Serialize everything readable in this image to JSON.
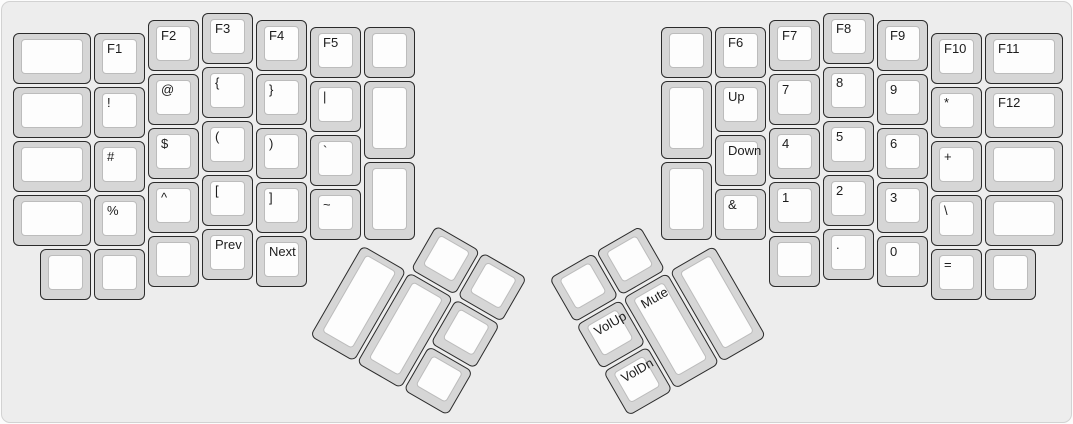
{
  "colors": {
    "board_background": "#ededed",
    "board_border": "#d2d2d2",
    "key_bezel": "#d6d6d6",
    "key_border": "#2b2b2b",
    "keytop": "#fdfdfd",
    "label_color": "#1c1c1c"
  },
  "keyboard": {
    "left_main": {
      "keys": [
        {
          "label": "",
          "name": "key-blank",
          "x": 0,
          "y": 0.375,
          "w": 1.5,
          "h": 1
        },
        {
          "label": "F1",
          "name": "key-f1",
          "x": 1.5,
          "y": 0.375,
          "w": 1,
          "h": 1
        },
        {
          "label": "F2",
          "name": "key-f2",
          "x": 2.5,
          "y": 0.125,
          "w": 1,
          "h": 1
        },
        {
          "label": "F3",
          "name": "key-f3",
          "x": 3.5,
          "y": 0,
          "w": 1,
          "h": 1
        },
        {
          "label": "F4",
          "name": "key-f4",
          "x": 4.5,
          "y": 0.125,
          "w": 1,
          "h": 1
        },
        {
          "label": "F5",
          "name": "key-f5",
          "x": 5.5,
          "y": 0.25,
          "w": 1,
          "h": 1
        },
        {
          "label": "",
          "name": "key-blank",
          "x": 6.5,
          "y": 0.25,
          "w": 1,
          "h": 1
        },
        {
          "label": "",
          "name": "key-blank",
          "x": 0,
          "y": 1.375,
          "w": 1.5,
          "h": 1
        },
        {
          "label": "!",
          "name": "key-exclamation",
          "x": 1.5,
          "y": 1.375,
          "w": 1,
          "h": 1
        },
        {
          "label": "@",
          "name": "key-at",
          "x": 2.5,
          "y": 1.125,
          "w": 1,
          "h": 1
        },
        {
          "label": "{",
          "name": "key-left-brace",
          "x": 3.5,
          "y": 1,
          "w": 1,
          "h": 1
        },
        {
          "label": "}",
          "name": "key-right-brace",
          "x": 4.5,
          "y": 1.125,
          "w": 1,
          "h": 1
        },
        {
          "label": "|",
          "name": "key-pipe",
          "x": 5.5,
          "y": 1.25,
          "w": 1,
          "h": 1
        },
        {
          "label": "",
          "name": "key-blank",
          "x": 6.5,
          "y": 1.25,
          "w": 1,
          "h": 1.5
        },
        {
          "label": "",
          "name": "key-blank",
          "x": 0,
          "y": 2.375,
          "w": 1.5,
          "h": 1
        },
        {
          "label": "#",
          "name": "key-hash",
          "x": 1.5,
          "y": 2.375,
          "w": 1,
          "h": 1
        },
        {
          "label": "$",
          "name": "key-dollar",
          "x": 2.5,
          "y": 2.125,
          "w": 1,
          "h": 1
        },
        {
          "label": "(",
          "name": "key-left-paren",
          "x": 3.5,
          "y": 2,
          "w": 1,
          "h": 1
        },
        {
          "label": ")",
          "name": "key-right-paren",
          "x": 4.5,
          "y": 2.125,
          "w": 1,
          "h": 1
        },
        {
          "label": "`",
          "name": "key-backtick",
          "x": 5.5,
          "y": 2.25,
          "w": 1,
          "h": 1
        },
        {
          "label": "",
          "name": "key-blank",
          "x": 0,
          "y": 3.375,
          "w": 1.5,
          "h": 1
        },
        {
          "label": "%",
          "name": "key-percent",
          "x": 1.5,
          "y": 3.375,
          "w": 1,
          "h": 1
        },
        {
          "label": "^",
          "name": "key-caret",
          "x": 2.5,
          "y": 3.125,
          "w": 1,
          "h": 1
        },
        {
          "label": "[",
          "name": "key-left-bracket",
          "x": 3.5,
          "y": 3,
          "w": 1,
          "h": 1
        },
        {
          "label": "]",
          "name": "key-right-bracket",
          "x": 4.5,
          "y": 3.125,
          "w": 1,
          "h": 1
        },
        {
          "label": "~",
          "name": "key-tilde",
          "x": 5.5,
          "y": 3.25,
          "w": 1,
          "h": 1
        },
        {
          "label": "",
          "name": "key-blank",
          "x": 6.5,
          "y": 2.75,
          "w": 1,
          "h": 1.5
        },
        {
          "label": "",
          "name": "key-blank",
          "x": 0.5,
          "y": 4.375,
          "w": 1,
          "h": 1
        },
        {
          "label": "",
          "name": "key-blank",
          "x": 1.5,
          "y": 4.375,
          "w": 1,
          "h": 1
        },
        {
          "label": "",
          "name": "key-blank",
          "x": 2.5,
          "y": 4.125,
          "w": 1,
          "h": 1
        },
        {
          "label": "Prev",
          "name": "key-prev-track",
          "x": 3.5,
          "y": 4,
          "w": 1,
          "h": 1
        },
        {
          "label": "Next",
          "name": "key-next-track",
          "x": 4.5,
          "y": 4.125,
          "w": 1,
          "h": 1
        }
      ]
    },
    "right_main": {
      "keys": [
        {
          "label": "",
          "name": "key-blank",
          "x": 0,
          "y": 0.25,
          "w": 1,
          "h": 1
        },
        {
          "label": "F6",
          "name": "key-f6",
          "x": 1,
          "y": 0.25,
          "w": 1,
          "h": 1
        },
        {
          "label": "F7",
          "name": "key-f7",
          "x": 2,
          "y": 0.125,
          "w": 1,
          "h": 1
        },
        {
          "label": "F8",
          "name": "key-f8",
          "x": 3,
          "y": 0,
          "w": 1,
          "h": 1
        },
        {
          "label": "F9",
          "name": "key-f9",
          "x": 4,
          "y": 0.125,
          "w": 1,
          "h": 1
        },
        {
          "label": "F10",
          "name": "key-f10",
          "x": 5,
          "y": 0.375,
          "w": 1,
          "h": 1
        },
        {
          "label": "F11",
          "name": "key-f11",
          "x": 6,
          "y": 0.375,
          "w": 1.5,
          "h": 1
        },
        {
          "label": "",
          "name": "key-blank",
          "x": 0,
          "y": 1.25,
          "w": 1,
          "h": 1.5
        },
        {
          "label": "Up",
          "name": "key-up",
          "x": 1,
          "y": 1.25,
          "w": 1,
          "h": 1
        },
        {
          "label": "7",
          "name": "key-7",
          "x": 2,
          "y": 1.125,
          "w": 1,
          "h": 1
        },
        {
          "label": "8",
          "name": "key-8",
          "x": 3,
          "y": 1,
          "w": 1,
          "h": 1
        },
        {
          "label": "9",
          "name": "key-9",
          "x": 4,
          "y": 1.125,
          "w": 1,
          "h": 1
        },
        {
          "label": "*",
          "name": "key-asterisk",
          "x": 5,
          "y": 1.375,
          "w": 1,
          "h": 1
        },
        {
          "label": "F12",
          "name": "key-f12",
          "x": 6,
          "y": 1.375,
          "w": 1.5,
          "h": 1
        },
        {
          "label": "Down",
          "name": "key-down",
          "x": 1,
          "y": 2.25,
          "w": 1,
          "h": 1
        },
        {
          "label": "4",
          "name": "key-4",
          "x": 2,
          "y": 2.125,
          "w": 1,
          "h": 1
        },
        {
          "label": "5",
          "name": "key-5",
          "x": 3,
          "y": 2,
          "w": 1,
          "h": 1
        },
        {
          "label": "6",
          "name": "key-6",
          "x": 4,
          "y": 2.125,
          "w": 1,
          "h": 1
        },
        {
          "label": "+",
          "name": "key-plus",
          "x": 5,
          "y": 2.375,
          "w": 1,
          "h": 1
        },
        {
          "label": "",
          "name": "key-blank",
          "x": 6,
          "y": 2.375,
          "w": 1.5,
          "h": 1
        },
        {
          "label": "",
          "name": "key-blank",
          "x": 0,
          "y": 2.75,
          "w": 1,
          "h": 1.5
        },
        {
          "label": "&",
          "name": "key-ampersand",
          "x": 1,
          "y": 3.25,
          "w": 1,
          "h": 1
        },
        {
          "label": "1",
          "name": "key-1",
          "x": 2,
          "y": 3.125,
          "w": 1,
          "h": 1
        },
        {
          "label": "2",
          "name": "key-2",
          "x": 3,
          "y": 3,
          "w": 1,
          "h": 1
        },
        {
          "label": "3",
          "name": "key-3",
          "x": 4,
          "y": 3.125,
          "w": 1,
          "h": 1
        },
        {
          "label": "\\",
          "name": "key-backslash",
          "x": 5,
          "y": 3.375,
          "w": 1,
          "h": 1
        },
        {
          "label": "",
          "name": "key-blank",
          "x": 6,
          "y": 3.375,
          "w": 1.5,
          "h": 1
        },
        {
          "label": "",
          "name": "key-blank",
          "x": 2,
          "y": 4.125,
          "w": 1,
          "h": 1
        },
        {
          "label": ".",
          "name": "key-period",
          "x": 3,
          "y": 4,
          "w": 1,
          "h": 1
        },
        {
          "label": "0",
          "name": "key-0",
          "x": 4,
          "y": 4.125,
          "w": 1,
          "h": 1
        },
        {
          "label": "=",
          "name": "key-equals",
          "x": 5,
          "y": 4.375,
          "w": 1,
          "h": 1
        },
        {
          "label": "",
          "name": "key-blank",
          "x": 6,
          "y": 4.375,
          "w": 1,
          "h": 1
        }
      ]
    },
    "left_thumb": {
      "rotation_deg": 30,
      "keys": [
        {
          "label": "",
          "name": "key-blank",
          "x": 1,
          "y": 0,
          "w": 1,
          "h": 1
        },
        {
          "label": "",
          "name": "key-blank",
          "x": 2,
          "y": 0,
          "w": 1,
          "h": 1
        },
        {
          "label": "",
          "name": "key-blank",
          "x": 0,
          "y": 1,
          "w": 1,
          "h": 2
        },
        {
          "label": "",
          "name": "key-blank",
          "x": 1,
          "y": 1,
          "w": 1,
          "h": 2
        },
        {
          "label": "",
          "name": "key-blank",
          "x": 2,
          "y": 1,
          "w": 1,
          "h": 1
        },
        {
          "label": "",
          "name": "key-blank",
          "x": 2,
          "y": 2,
          "w": 1,
          "h": 1
        }
      ]
    },
    "right_thumb": {
      "rotation_deg": -30,
      "keys": [
        {
          "label": "",
          "name": "key-blank",
          "x": 0,
          "y": 0,
          "w": 1,
          "h": 1
        },
        {
          "label": "",
          "name": "key-blank",
          "x": 1,
          "y": 0,
          "w": 1,
          "h": 1
        },
        {
          "label": "VolUp",
          "name": "key-volume-up",
          "x": 0,
          "y": 1,
          "w": 1,
          "h": 1
        },
        {
          "label": "Mute",
          "name": "key-mute",
          "x": 1,
          "y": 1,
          "w": 1,
          "h": 2
        },
        {
          "label": "",
          "name": "key-blank",
          "x": 2,
          "y": 1,
          "w": 1,
          "h": 2
        },
        {
          "label": "VolDn",
          "name": "key-volume-down",
          "x": 0,
          "y": 2,
          "w": 1,
          "h": 1
        }
      ]
    }
  }
}
